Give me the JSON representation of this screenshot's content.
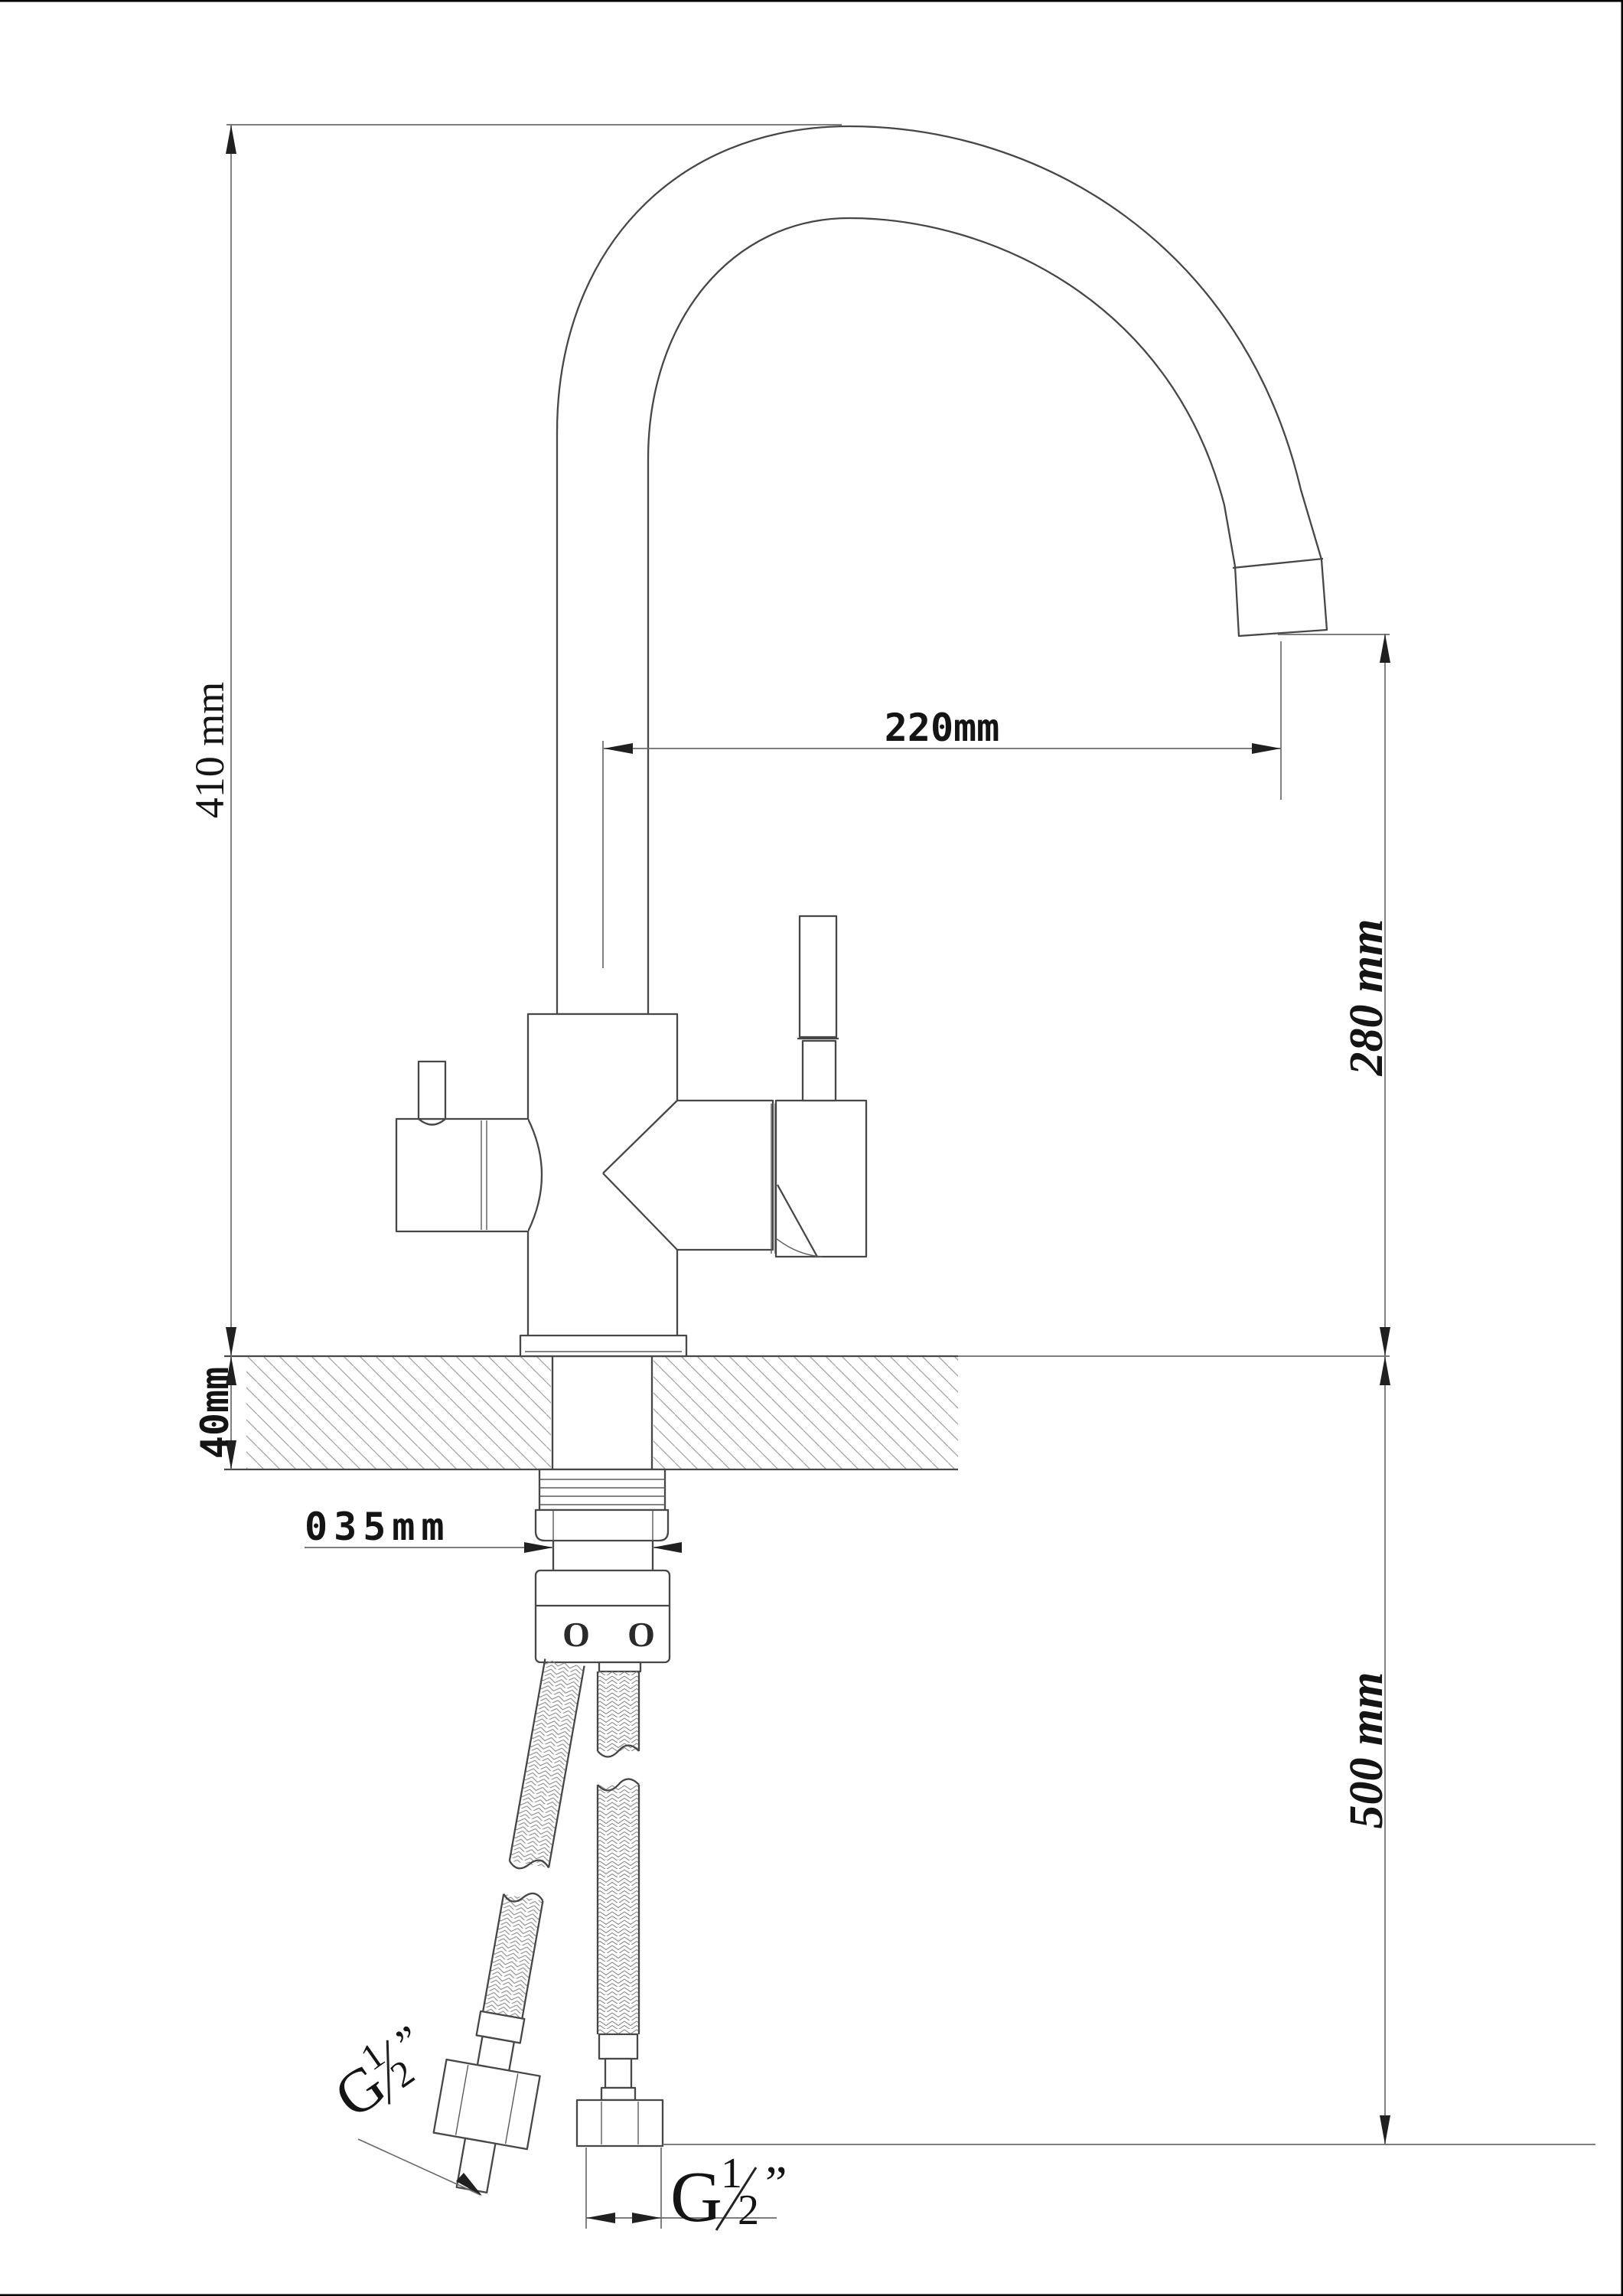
{
  "page": {
    "background": "#ffffff",
    "outline_color": "#474747",
    "dim_color": "#6b6b6b",
    "text_color": "#141414",
    "hatch_color": "#a0a0a0",
    "braid_color": "#8a8a8a",
    "frame_color": "#000000"
  },
  "dimensions": {
    "total_height": {
      "label": "410 mm"
    },
    "counter_thickness": {
      "label": "40mm"
    },
    "spout_reach": {
      "label": "220mm"
    },
    "outlet_height": {
      "label": "280 mm"
    },
    "hose_length": {
      "label": "500 mm"
    },
    "hole_diameter": {
      "label": "035mm"
    },
    "thread_left": {
      "letter": "G",
      "numerator": "1",
      "denominator": "2",
      "unit": "”"
    },
    "thread_right": {
      "letter": "G",
      "numerator": "1",
      "denominator": "2",
      "unit": "”"
    }
  },
  "adapter": {
    "mark_left": "O",
    "mark_right": "O"
  }
}
